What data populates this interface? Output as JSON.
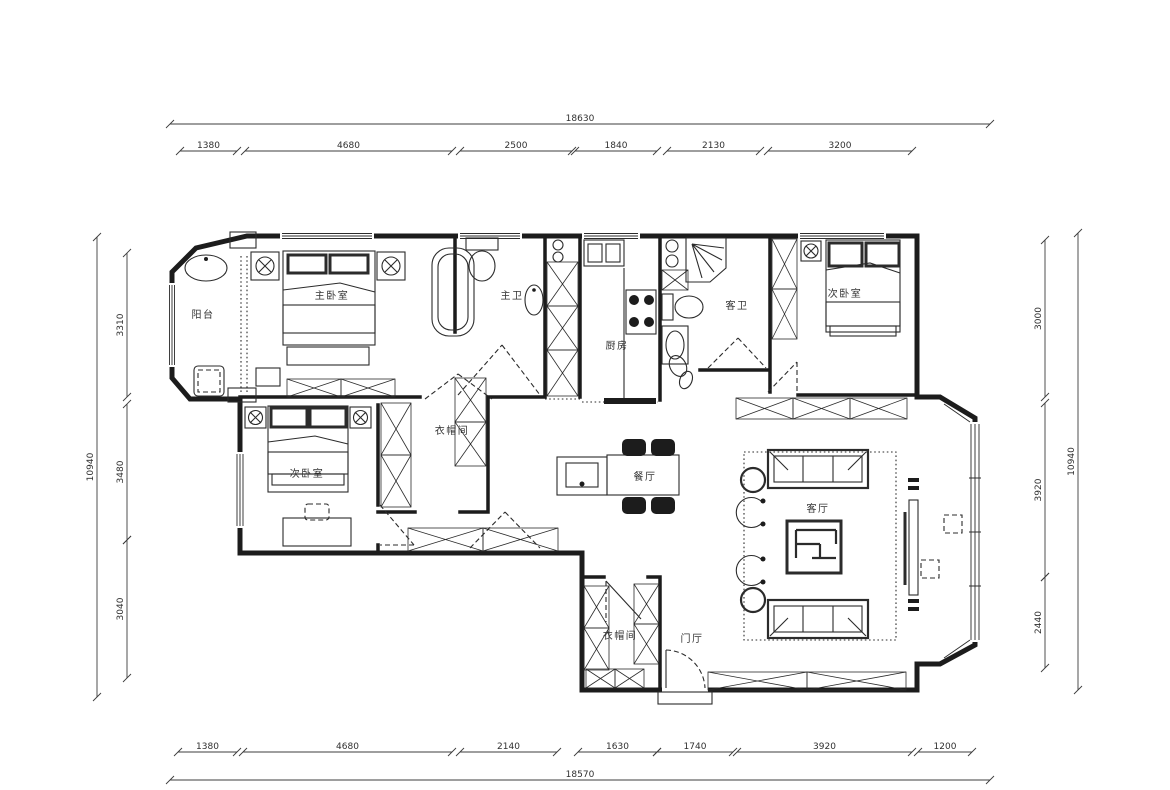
{
  "rooms": {
    "balcony": {
      "label": "阳台"
    },
    "master_bedroom": {
      "label": "主卧室"
    },
    "master_bath": {
      "label": "主卫"
    },
    "kitchen": {
      "label": "厨房"
    },
    "guest_bath": {
      "label": "客卫"
    },
    "bedroom2": {
      "label": "次卧室"
    },
    "closet1": {
      "label": "衣帽间"
    },
    "bedroom3": {
      "label": "次卧室"
    },
    "dining": {
      "label": "餐厅"
    },
    "living": {
      "label": "客厅"
    },
    "closet2": {
      "label": "衣帽间"
    },
    "foyer": {
      "label": "门厅"
    }
  },
  "dims": {
    "top": {
      "overall": "18630",
      "segments": [
        "1380",
        "4680",
        "2500",
        "1840",
        "2130",
        "3200"
      ]
    },
    "bottom": {
      "overall": "18570",
      "segments": [
        "1380",
        "4680",
        "2140",
        "1630",
        "1740",
        "3920",
        "1200"
      ]
    },
    "left": {
      "overall": "10940",
      "segments": [
        "3310",
        "3480",
        "3040"
      ]
    },
    "right": {
      "overall": "10940",
      "segments": [
        "3000",
        "3920",
        "2440"
      ]
    }
  },
  "colors": {
    "line": "#1c1c1c",
    "background": "#ffffff"
  }
}
